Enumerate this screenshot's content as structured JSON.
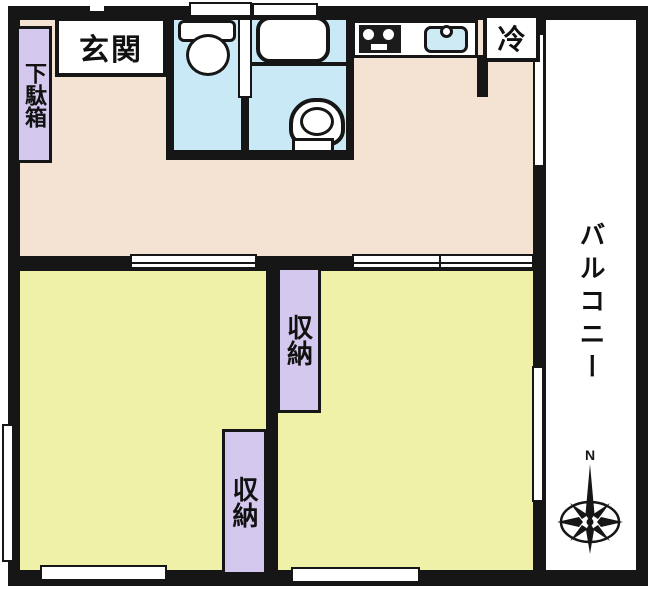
{
  "floorplan": {
    "type": "japanese-apartment-floor-plan",
    "labels": {
      "entrance": "玄関",
      "shoe_cabinet": "下駄箱",
      "refrigerator": "冷",
      "storage_upper": "収納",
      "storage_lower": "収納",
      "balcony": "バルコニー",
      "compass_north": "N"
    },
    "icons": {
      "compass": "compass-rose-8-point",
      "toilet": "toilet-top-view",
      "bathtub": "bathtub-top-view",
      "washbasin": "washbasin-top-view",
      "stove": "gas-stove-top-view",
      "sink": "kitchen-sink-top-view"
    },
    "colors": {
      "wall": "#161616",
      "hall_floor": "#f4e2d2",
      "room_floor": "#f0f1a9",
      "bath_floor": "#c9e9f7",
      "storage_fill": "#d5c8ee",
      "label_box_fill": "#ffffff",
      "sink_fill": "#cdeaf5",
      "balcony_fill": "#ffffff"
    }
  }
}
